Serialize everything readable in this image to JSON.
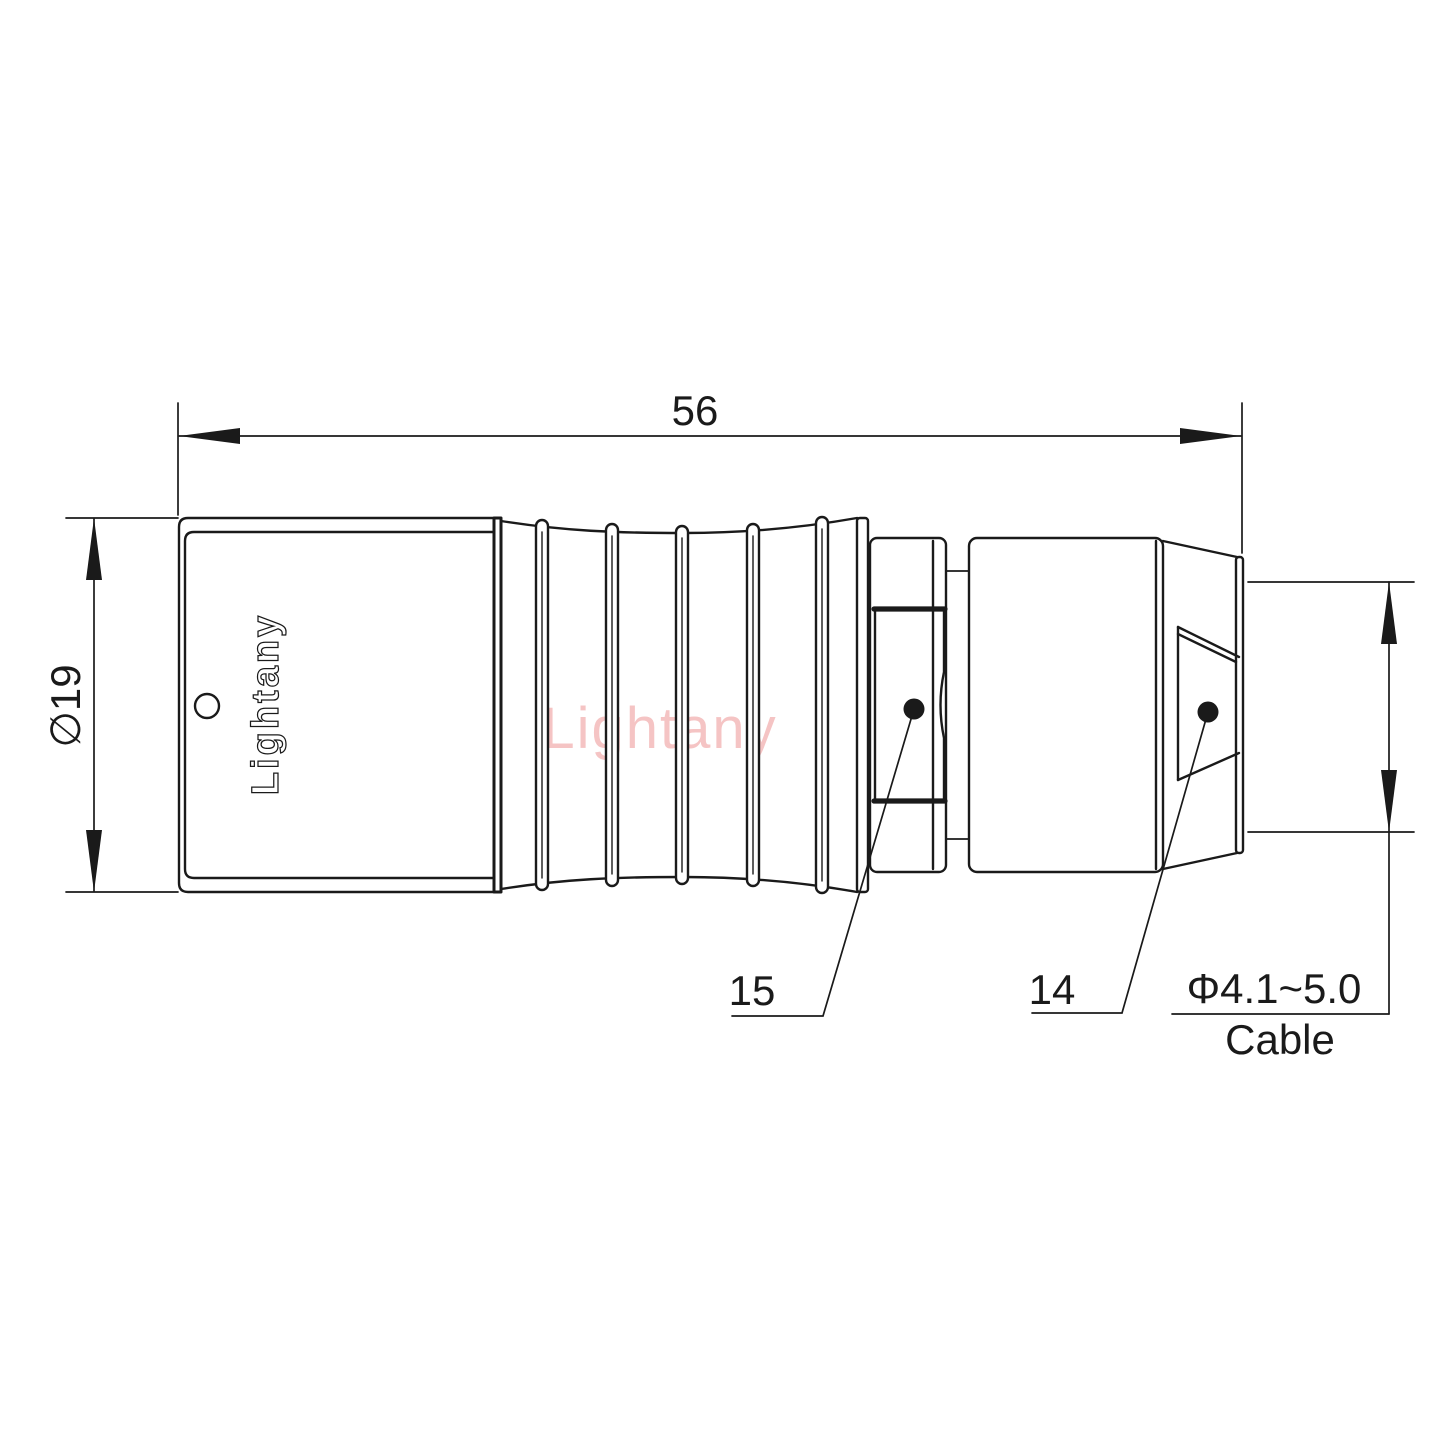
{
  "colors": {
    "line": "#1a1a1a",
    "watermark": "#f5c4c4",
    "pagebg": "#ffffff"
  },
  "drawing": {
    "brand_engraving": "Lightany",
    "watermark_text": "Lightany",
    "dim_overall_length": "56",
    "dim_body_diameter": "∅19",
    "dim_cable_range": "Φ4.1~5.0",
    "dim_cable_caption": "Cable",
    "callout_backnut": "15",
    "callout_boot": "14"
  }
}
